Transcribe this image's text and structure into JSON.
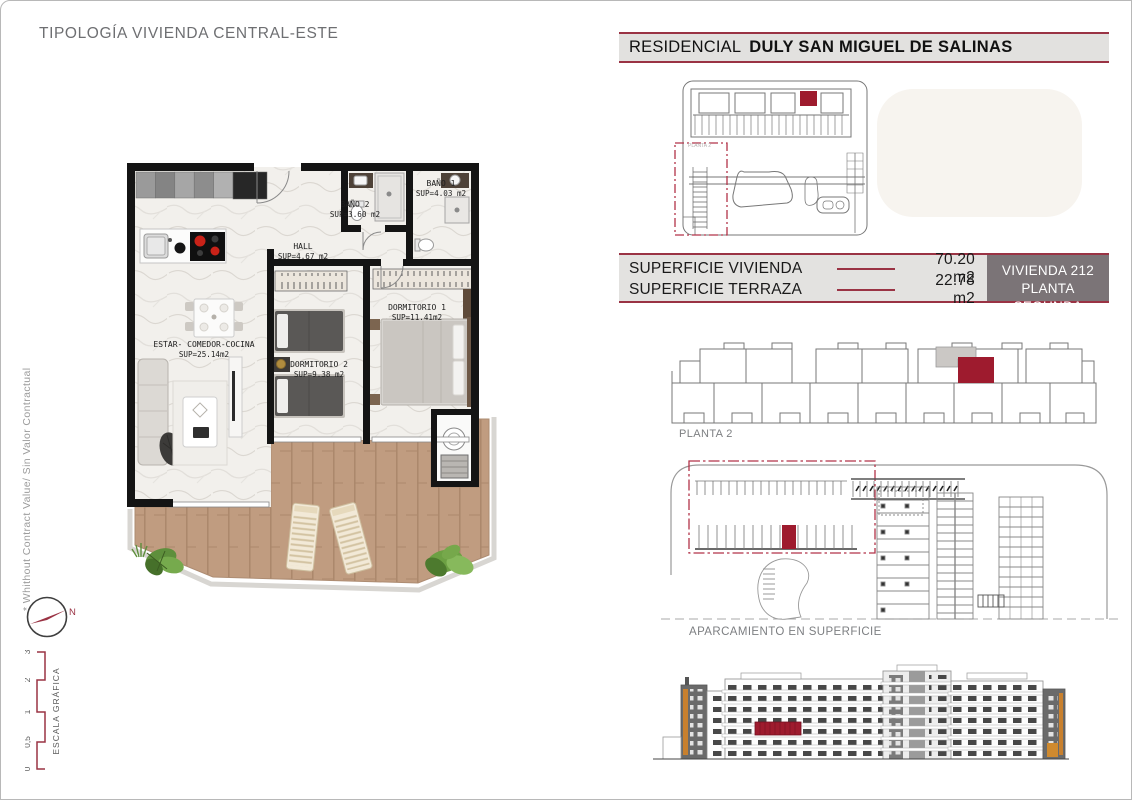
{
  "title": "TIPOLOGÍA VIVIENDA CENTRAL-ESTE",
  "side_note": "* Whithout Contract Value/ Sin Valor Contractual",
  "header": {
    "prefix": "RESIDENCIAL",
    "name": "DULY SAN MIGUEL DE SALINAS"
  },
  "surfaces": {
    "rows": [
      {
        "label": "SUPERFICIE VIVIENDA",
        "value": "70.20 m2"
      },
      {
        "label": "SUPERFICIE TERRAZA",
        "value": "22.78 m2"
      }
    ],
    "badge": {
      "line1": "VIVIENDA 212",
      "line2": "PLANTA SEGUNDA"
    }
  },
  "floorplan": {
    "rooms": {
      "bano2": {
        "name": "BAÑO 2",
        "sup": "SUP=3.60 m2"
      },
      "bano1": {
        "name": "BAÑO 1",
        "sup": "SUP=4.03 m2"
      },
      "hall": {
        "name": "HALL",
        "sup": "SUP=4.67 m2"
      },
      "estar": {
        "name": "ESTAR- COMEDOR-COCINA",
        "sup": "SUP=25.14m2"
      },
      "dorm2": {
        "name": "DORMITORIO 2",
        "sup": "SUP=9.38 m2"
      },
      "dorm1": {
        "name": "DORMITORIO 1",
        "sup": "SUP=11.41m2"
      }
    }
  },
  "diagrams": {
    "site_label": "PLANTA 2",
    "planta2_label": "PLANTA 2",
    "parking_label": "APARCAMIENTO EN SUPERFICIE"
  },
  "compass": {
    "north": "N"
  },
  "scale": {
    "label": "ESCALA GRÁFICA",
    "ticks": [
      "0",
      "0,5",
      "1",
      "2",
      "3"
    ]
  },
  "colors": {
    "accent_red": "#9e1b2e",
    "line_maroon": "#9a3344",
    "badge_bg": "#7b7477"
  }
}
